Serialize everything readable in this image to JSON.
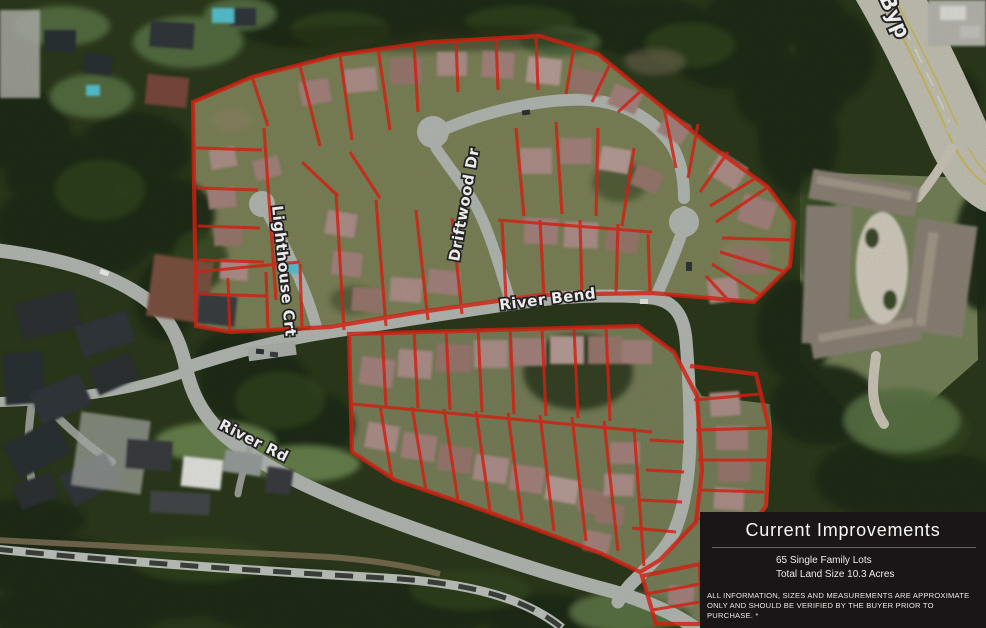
{
  "map": {
    "street_labels": {
      "driftwood": "Driftwood Dr",
      "lighthouse": "Lighthouse Crt",
      "river_bend": "River Bend",
      "river_rd": "River Rd",
      "bypass": "Byp"
    }
  },
  "panel": {
    "title": "Current Improvements",
    "lines": {
      "lots": "65 Single Family Lots",
      "size": "Total Land Size 10.3 Acres"
    },
    "disclaimer": "ALL INFORMATION, SIZES AND MEASUREMENTS ARE APPROXIMATE ONLY AND SHOULD BE VERIFIED BY THE BUYER PRIOR TO PURCHASE. *"
  },
  "colors": {
    "lot_outline": "#e32313",
    "panel_background": "#1a1516",
    "panel_text": "#f3f1f0"
  }
}
